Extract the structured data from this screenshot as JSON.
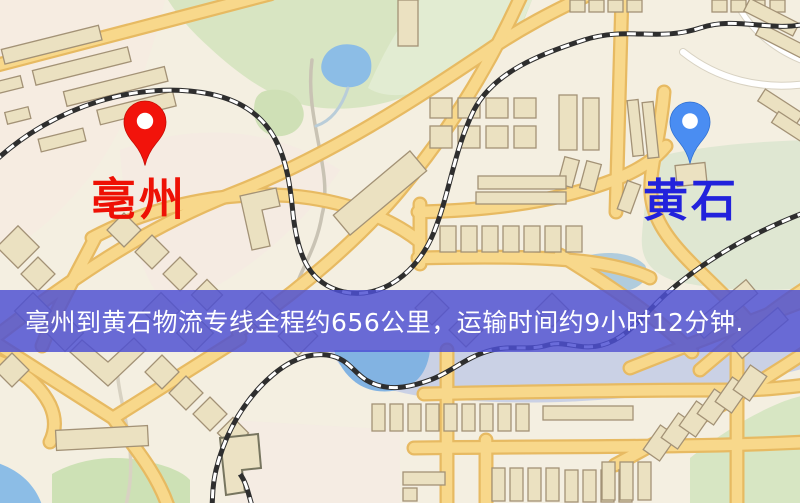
{
  "map": {
    "colors": {
      "background": "#f4efe1",
      "road_fill": "#f8d88b",
      "road_casing": "#e7ba62",
      "building_fill": "#ebe1c1",
      "building_outline": "#a39276",
      "park_green": "#d8e5c2",
      "water_blue": "#8cbde6",
      "railway_dark": "#2e2e2e"
    }
  },
  "pins": {
    "origin": {
      "label": "亳州",
      "pin_color": "#f2130b",
      "label_color": "#ee1105"
    },
    "destination": {
      "label": "黄石",
      "pin_color": "#4a8df2",
      "label_color": "#2222dc"
    }
  },
  "banner": {
    "text": "亳州到黄石物流专线全程约656公里，运输时间约9小时12分钟.",
    "background_color": "#4d50d3",
    "text_color": "#ffffff"
  },
  "route": {
    "origin": "亳州",
    "destination": "黄石",
    "distance": "约656公里",
    "duration": "约9小时12分钟"
  }
}
